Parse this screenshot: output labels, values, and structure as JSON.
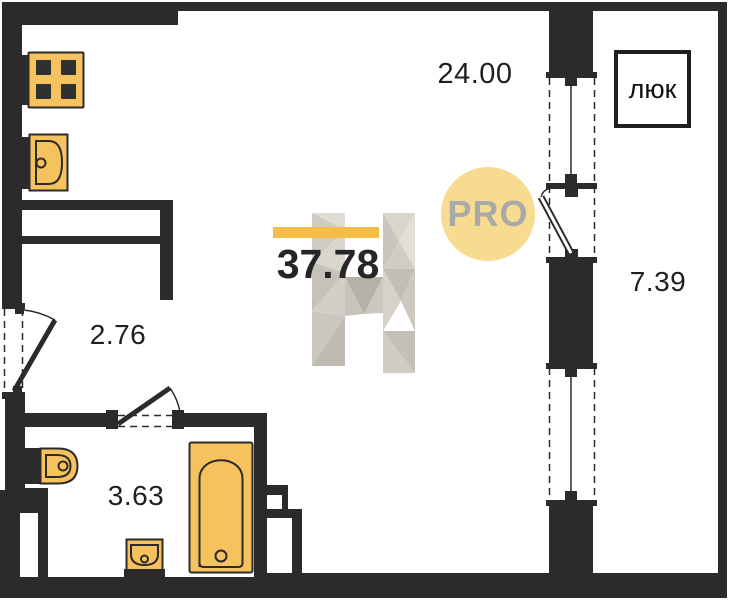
{
  "plan": {
    "labels": {
      "kitchen_living_area": "24.00",
      "total_area": "37.78",
      "hallway_area": "2.76",
      "bathroom_area": "3.63",
      "balcony_area": "7.39",
      "hatch": "люк"
    },
    "badge": {
      "text": "PRO"
    },
    "colors": {
      "wall": "#2b2b2b",
      "fixture_fill": "#f6c25e",
      "accent_bar": "#f4bd45",
      "badge_bg": "#f7db90",
      "badge_text": "#a9a9a9",
      "label_text": "#1f1f1f",
      "watermark_light": "#dcd8d0",
      "watermark_dark": "#bcb7ae"
    }
  }
}
